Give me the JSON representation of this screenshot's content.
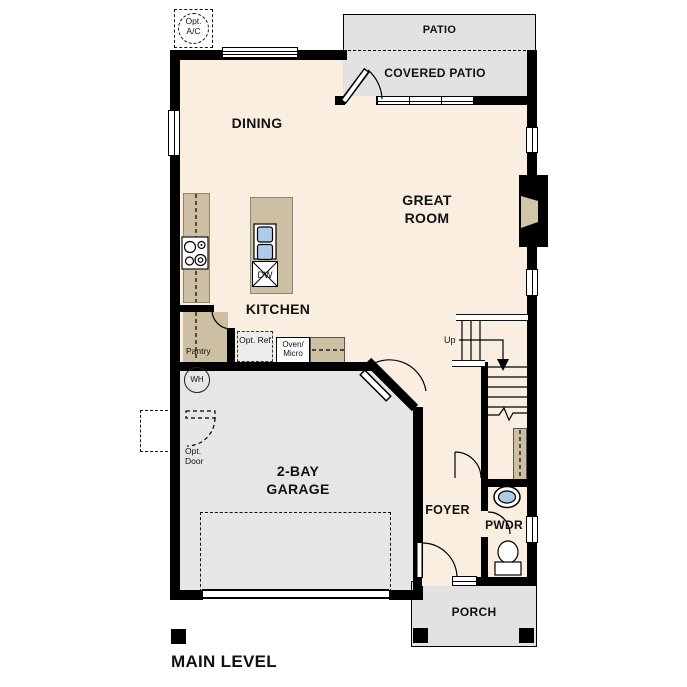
{
  "title": "MAIN LEVEL",
  "colors": {
    "wall": "#000000",
    "floor": "#f9eee0",
    "garage": "#e6e6e6",
    "patio": "#e2e2e2",
    "counter": "#cdbfa1",
    "sink": "#aecbe8",
    "inset": "#d3c5a9",
    "ink": "#111111"
  },
  "labels": {
    "opt_ac": "Opt. A/C",
    "patio": "PATIO",
    "covered_patio": "COVERED PATIO",
    "dining": "DINING",
    "great_room": "GREAT ROOM",
    "kitchen": "KITCHEN",
    "pantry": "Pantry",
    "opt_ref": "Opt. Ref",
    "oven_micro": "Oven/ Micro",
    "dw": "DW",
    "wh": "WH",
    "up": "Up",
    "opt_door": "Opt. Door",
    "garage": "2-BAY GARAGE",
    "foyer": "FOYER",
    "pwdr": "PWDR",
    "porch": "PORCH",
    "main_level": "MAIN LEVEL"
  }
}
